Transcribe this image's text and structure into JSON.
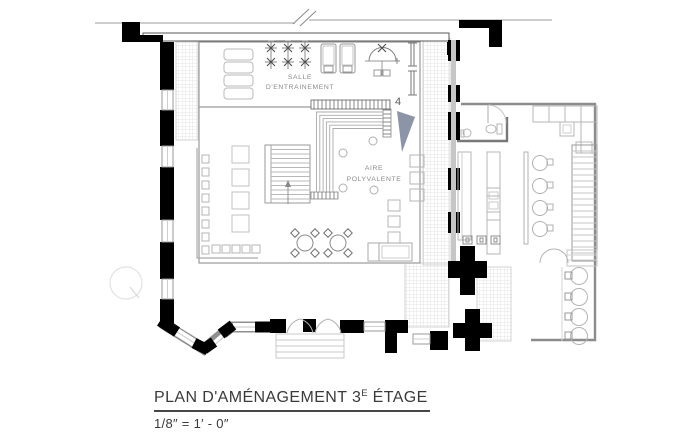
{
  "title_block": {
    "title_prefix": "PLAN D'AMÉNAGEMENT 3",
    "title_superscript": "E",
    "title_suffix": " ÉTAGE",
    "scale": "1/8″ = 1′ - 0″"
  },
  "plan": {
    "rooms": {
      "training_room": {
        "label_line1": "SALLE",
        "label_line2": "D'ENTRAINEMENT"
      },
      "multipurpose_area": {
        "label_line1": "AIRE",
        "label_line2": "POLYVALENTE"
      }
    },
    "section_marker": {
      "number": "4"
    }
  },
  "colors": {
    "wall_black": "#000000",
    "wall_mid_gray": "#8c8c8c",
    "furniture_light": "#b5b5b5",
    "hatch_gray": "#d9d9d9",
    "section_arrow": "#8b95a7",
    "label_gray": "#8a8a8a",
    "title_gray": "#3a3a3a"
  }
}
